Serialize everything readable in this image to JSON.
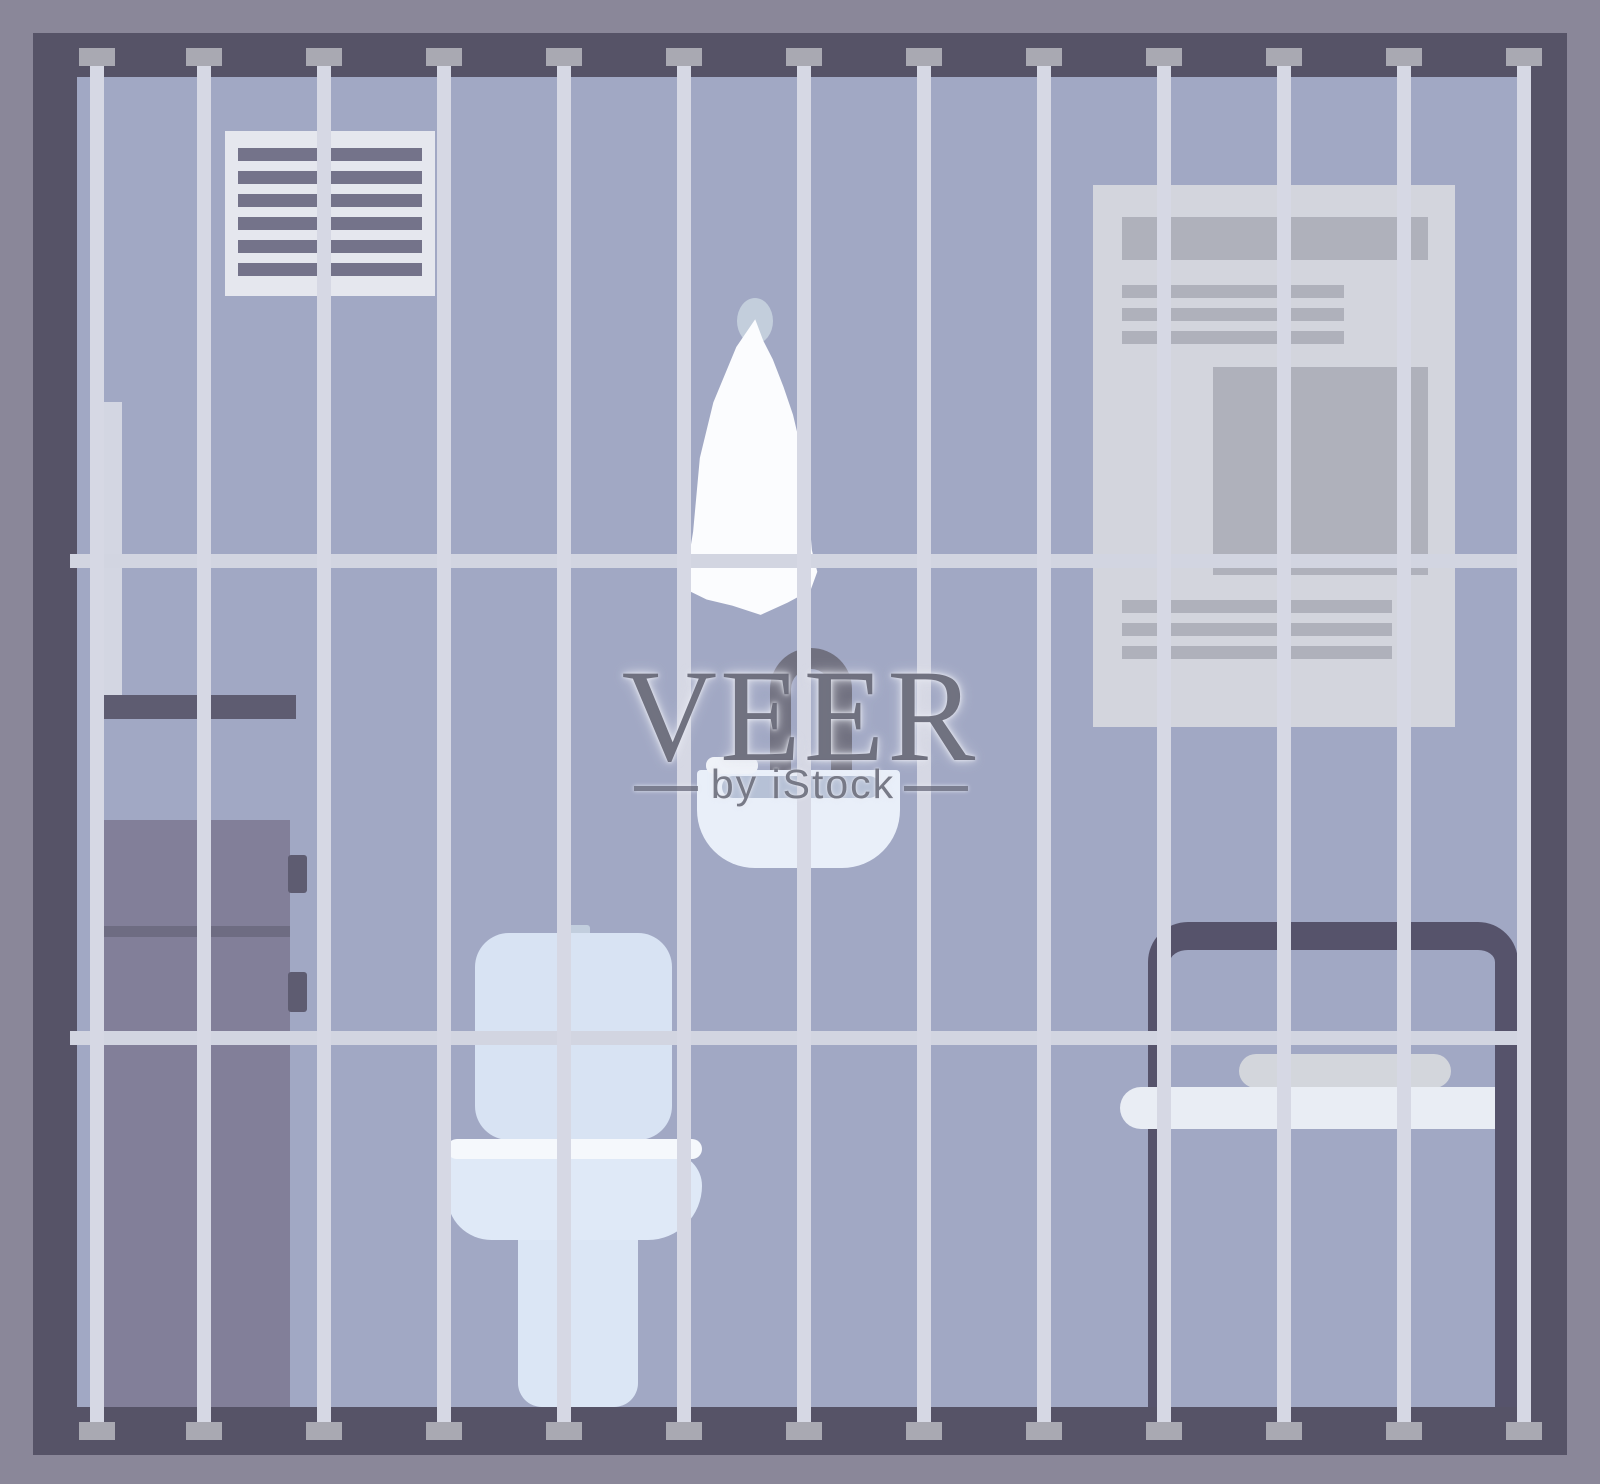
{
  "watermark": {
    "title": "VEER",
    "subtitle": "by iStock"
  },
  "scene": {
    "subject": "prison-cell-room-behind-bars",
    "objects": [
      "ventilation-grille",
      "wall-poster",
      "water-pipe",
      "wall-shelf",
      "storage-cabinet",
      "toilet",
      "sink",
      "faucet",
      "soap-bar",
      "towel-hook",
      "hanging-towel",
      "table-frame",
      "rolled-towel",
      "tabletop",
      "prison-bars"
    ]
  },
  "colors": {
    "outer-border": "#8A8799",
    "cage-frame": "#565367",
    "wall": "#A1A8C4",
    "bar": "#D6D8E4",
    "bar-cap": "#A9A9B2",
    "rail": "#D2D5E1",
    "vent-panel": "#E5E7EE",
    "vent-slat": "#74738A",
    "poster-paper": "#D3D5DD",
    "poster-block": "#AFB1BB",
    "pipe": "#D3D6E2",
    "shelf": "#5E5C71",
    "cabinet": "#827F99",
    "cabinet-dark": "#6E6C82",
    "handle": "#5E5C71",
    "toilet-tank": "#D8E3F3",
    "toilet-seat": "#F5F8FC",
    "toilet-bowl": "#DFE9F7",
    "toilet-pedestal": "#DBE6F5",
    "flush-button": "#C2CEDE",
    "sink": "#E9EFF9",
    "sink-shadow": "#B6C1D6",
    "soap": "#EFF2F8",
    "faucet": "#70707F",
    "towel": "#FBFCFE",
    "towel-hook": "#C3CEDC",
    "table-frame": "#56536B",
    "tabletop": "#E9EDF4",
    "rolled-towel": "#D3D6DC",
    "watermark-text": "#606170"
  }
}
